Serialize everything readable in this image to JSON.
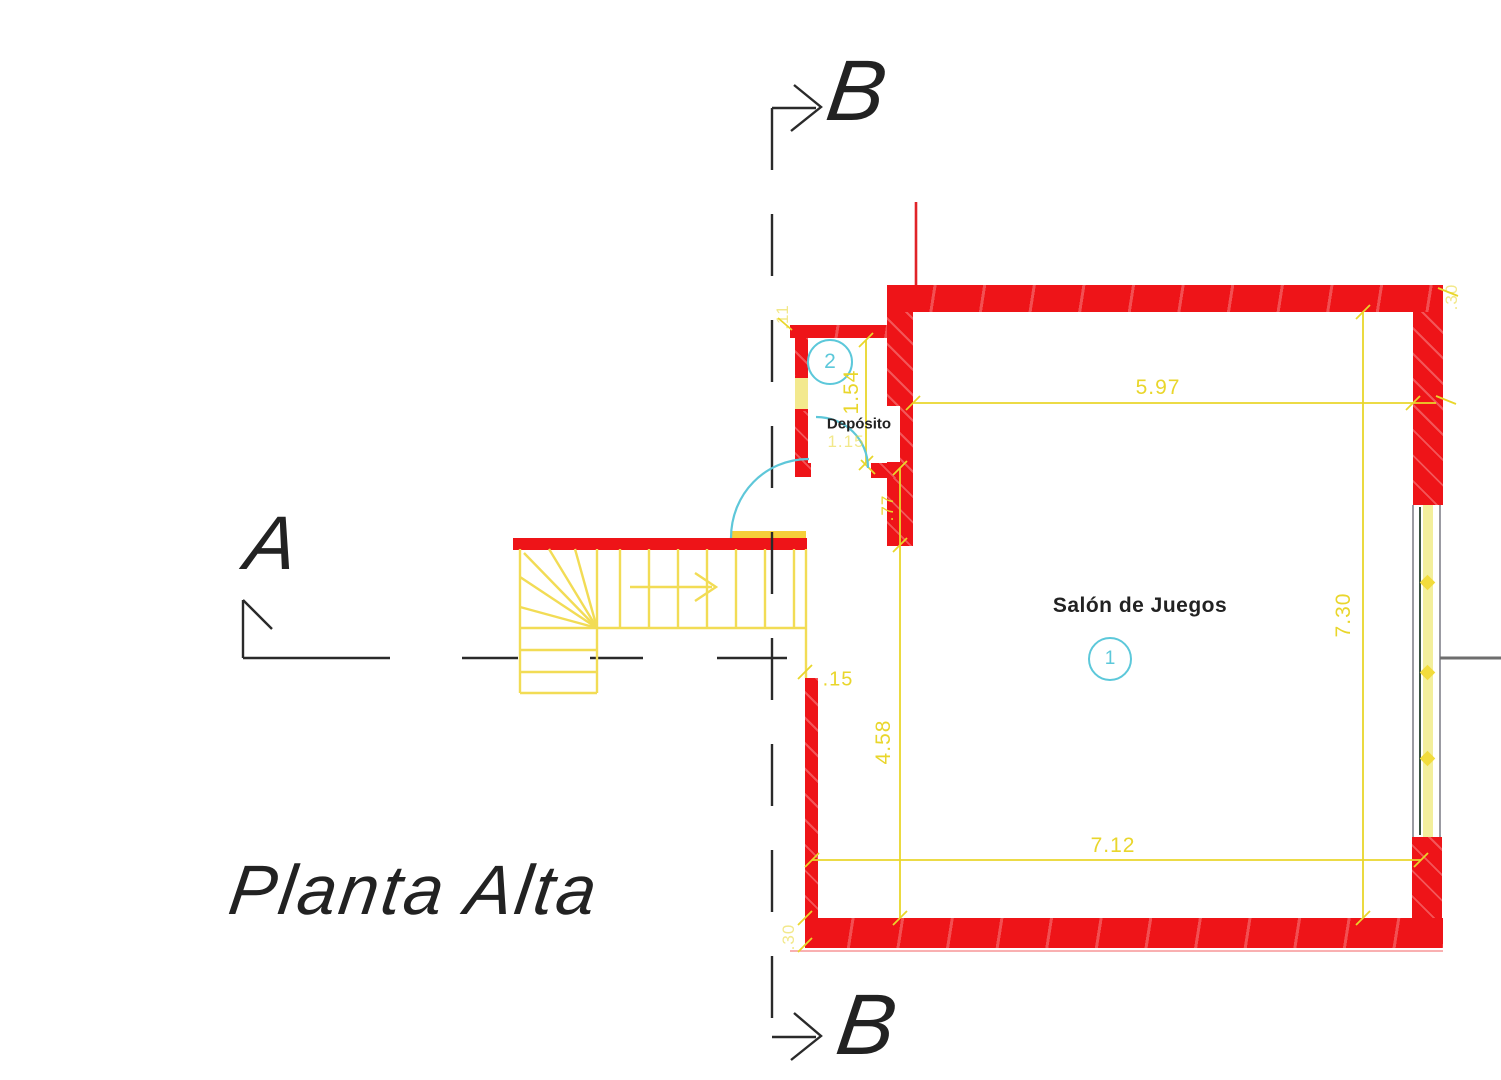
{
  "drawing": {
    "title": "Planta Alta",
    "section_a_label": "A",
    "section_b_top_label": "B",
    "section_b_bottom_label": "B",
    "rooms": {
      "salon": {
        "name": "Salón de Juegos",
        "number": "1"
      },
      "deposito": {
        "name": "Depósito",
        "number": "2"
      }
    },
    "dimensions": {
      "salon_width_top": "5.97",
      "salon_height_right": "7.30",
      "salon_height_left": "4.58",
      "salon_width_bottom": "7.12",
      "deposito_height": "1.54",
      "deposito_door_width": "1.15",
      "wall_segment_right_of_door": ".77",
      "thin_wall_thickness": ".15",
      "deposito_wall_thickness": ".11",
      "top_right_wall_thickness": ".30",
      "bottom_left_wall_thickness": ".30"
    },
    "colors": {
      "wall_red": "#ee1418",
      "dimension_yellow": "#e9d62b",
      "stair_yellow": "#f2dc55",
      "annotation_cyan": "#5cc8da",
      "section_line_black": "#2a2a2a"
    }
  }
}
